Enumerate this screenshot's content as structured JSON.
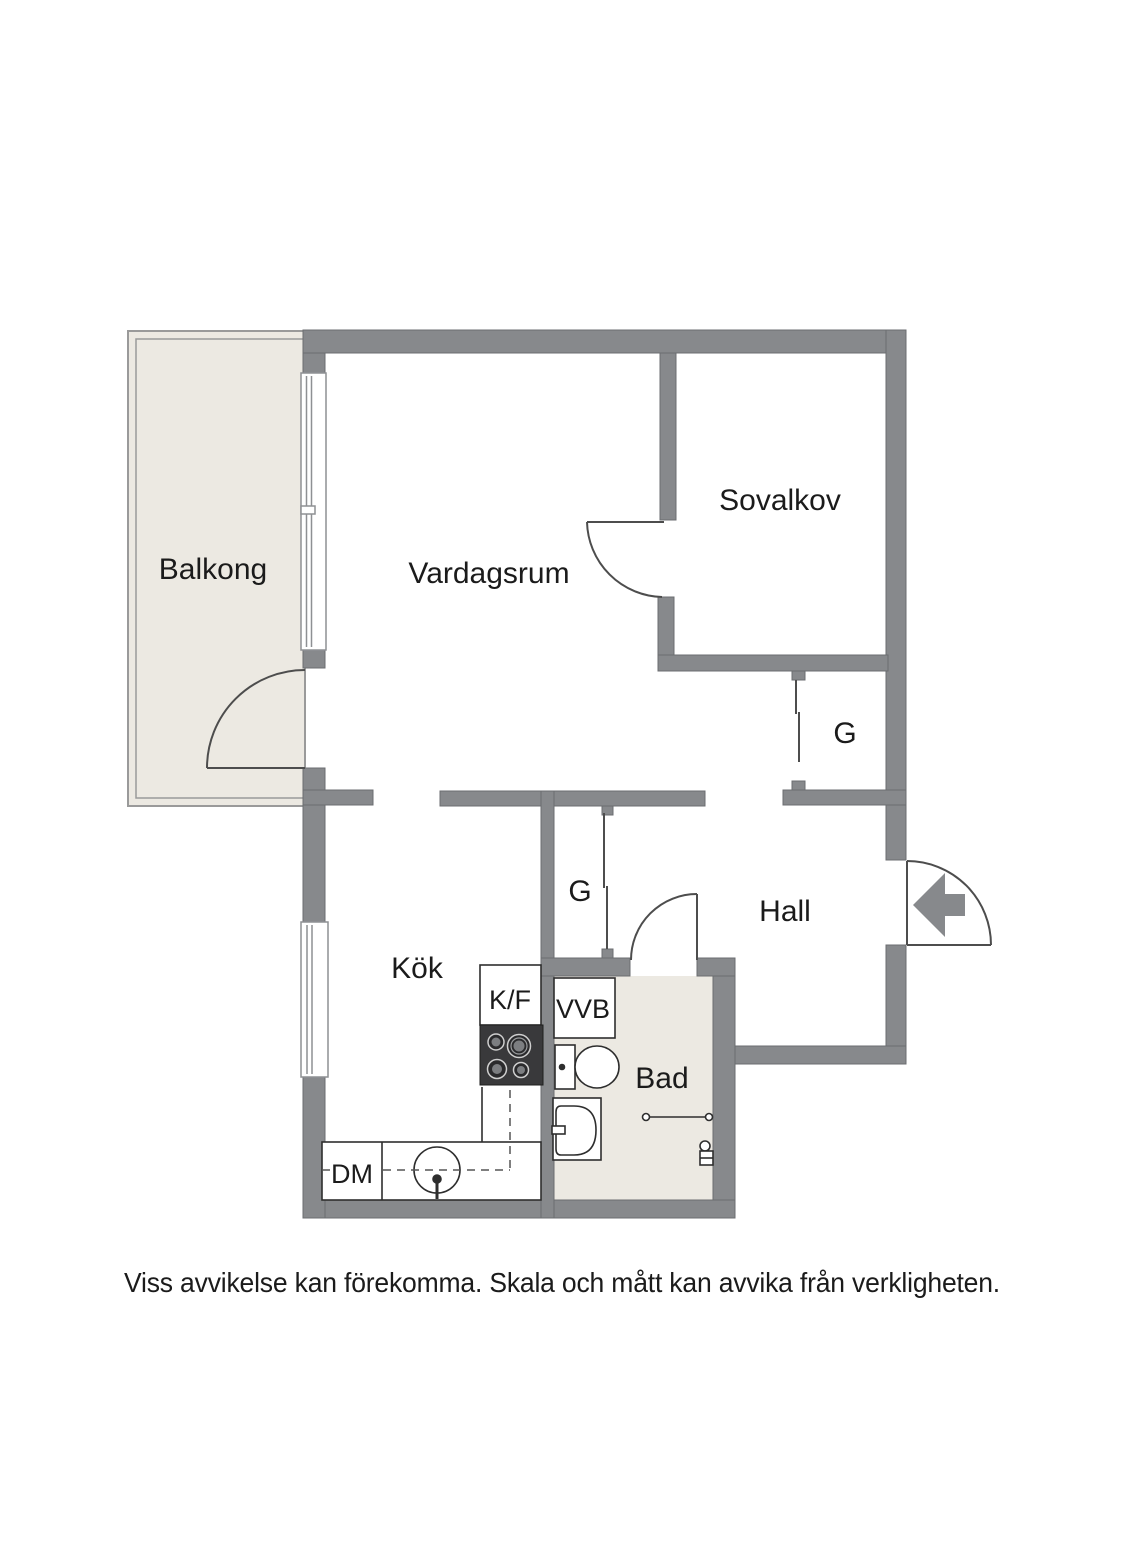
{
  "labels": {
    "balcony": "Balkong",
    "living_room": "Vardagsrum",
    "sleeping_alcove": "Sovalkov",
    "wardrobe_top": "G",
    "wardrobe_mid": "G",
    "hall": "Hall",
    "kitchen": "Kök",
    "fridge_freezer": "K/F",
    "water_heater": "VVB",
    "bathroom": "Bad",
    "dishwasher": "DM",
    "disclaimer": "Viss avvikelse kan förekomma. Skala och mått kan avvika från verkligheten."
  },
  "colors": {
    "wall": "#87898c",
    "wall_edge": "#6b6d70",
    "floor": "#ece9e2",
    "floor_edge": "#9a9a9a",
    "line": "#4d4d4d",
    "fixture": "#2e2e2e",
    "stove": "#39393b",
    "text": "#1b1b1b"
  }
}
